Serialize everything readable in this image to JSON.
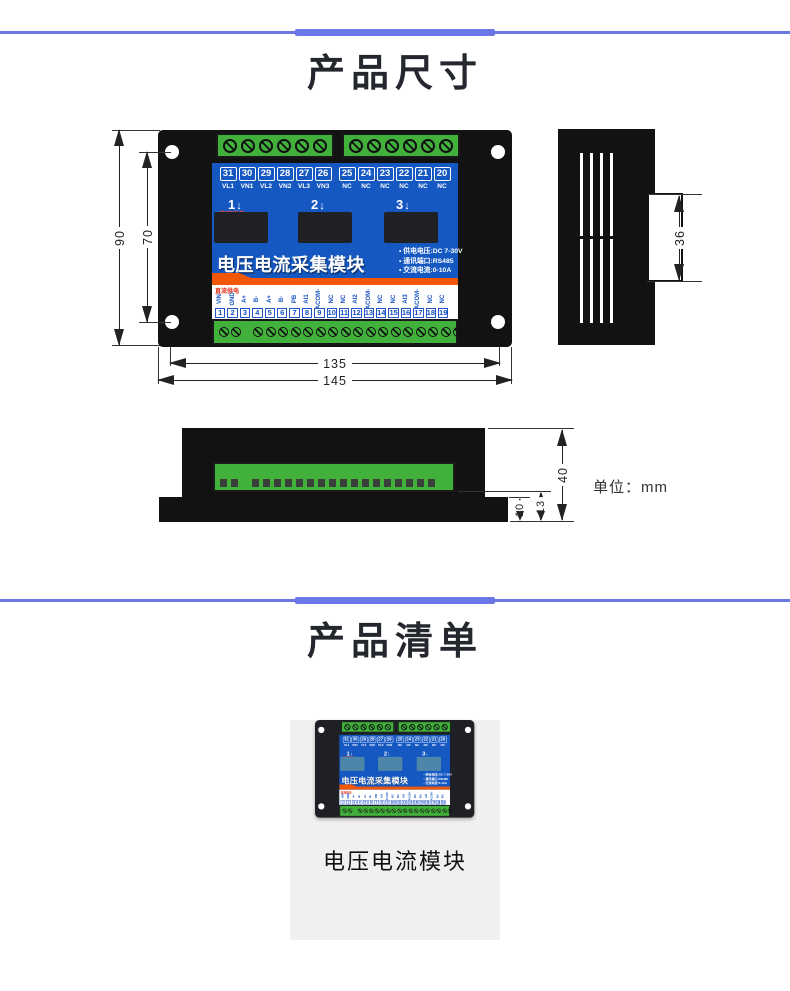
{
  "colors": {
    "divider_blue": "#6b77e6",
    "panel_blue": "#1558c2",
    "stripe_orange": "#f25708",
    "terminal_green": "#42b13c",
    "case_black": "#121212",
    "card_gray": "#f0f0f0",
    "red_label": "#e43018"
  },
  "section_dimensions": {
    "title": "产品尺寸",
    "unit_label": "单位：mm",
    "front_view": {
      "top_numbers": [
        "31",
        "30",
        "29",
        "28",
        "27",
        "26",
        "25",
        "24",
        "23",
        "22",
        "21",
        "20"
      ],
      "top_labels": [
        "VL1",
        "VN1",
        "VL2",
        "VN2",
        "VL3",
        "VN3",
        "NC",
        "NC",
        "NC",
        "NC",
        "NC",
        "NC"
      ],
      "ac_power_label": "交流供电",
      "channel_markers": [
        "1",
        "2",
        "3"
      ],
      "arrow_glyph": "↓",
      "panel_title": "电压电流采集模块",
      "specs": [
        "• 供电电压:DC 7-30V",
        "• 通讯端口:RS485",
        "• 交流电流:0-10A"
      ],
      "dc_power_label": "直流供电",
      "bottom_labels": [
        "VIN",
        "GND",
        "A+",
        "B-",
        "A+",
        "B-",
        "PB",
        "AI1",
        "ACOM-",
        "NC",
        "NC",
        "AI2",
        "ACOM-",
        "NC",
        "NC",
        "AI3",
        "ACOM-",
        "NC",
        "NC"
      ],
      "bottom_numbers": [
        "1",
        "2",
        "3",
        "4",
        "5",
        "6",
        "7",
        "8",
        "9",
        "10",
        "11",
        "12",
        "13",
        "14",
        "15",
        "16",
        "17",
        "18",
        "19"
      ],
      "screws_per_top_block": 6,
      "screws_bottom_left": 2,
      "screws_bottom_right": 17,
      "dim_height_outer": "90",
      "dim_height_inner": "70",
      "dim_width_inner": "135",
      "dim_width_outer": "145"
    },
    "side_view": {
      "vent_slots_per_group": 4,
      "dim_clip_height": "36"
    },
    "bottom_view": {
      "holes_left": 2,
      "holes_right": 17,
      "dim_height_total": "40",
      "dim_height_terminal": "13",
      "dim_height_flange": "10"
    }
  },
  "section_list": {
    "title": "产品清单",
    "item_label": "电压电流模块"
  }
}
